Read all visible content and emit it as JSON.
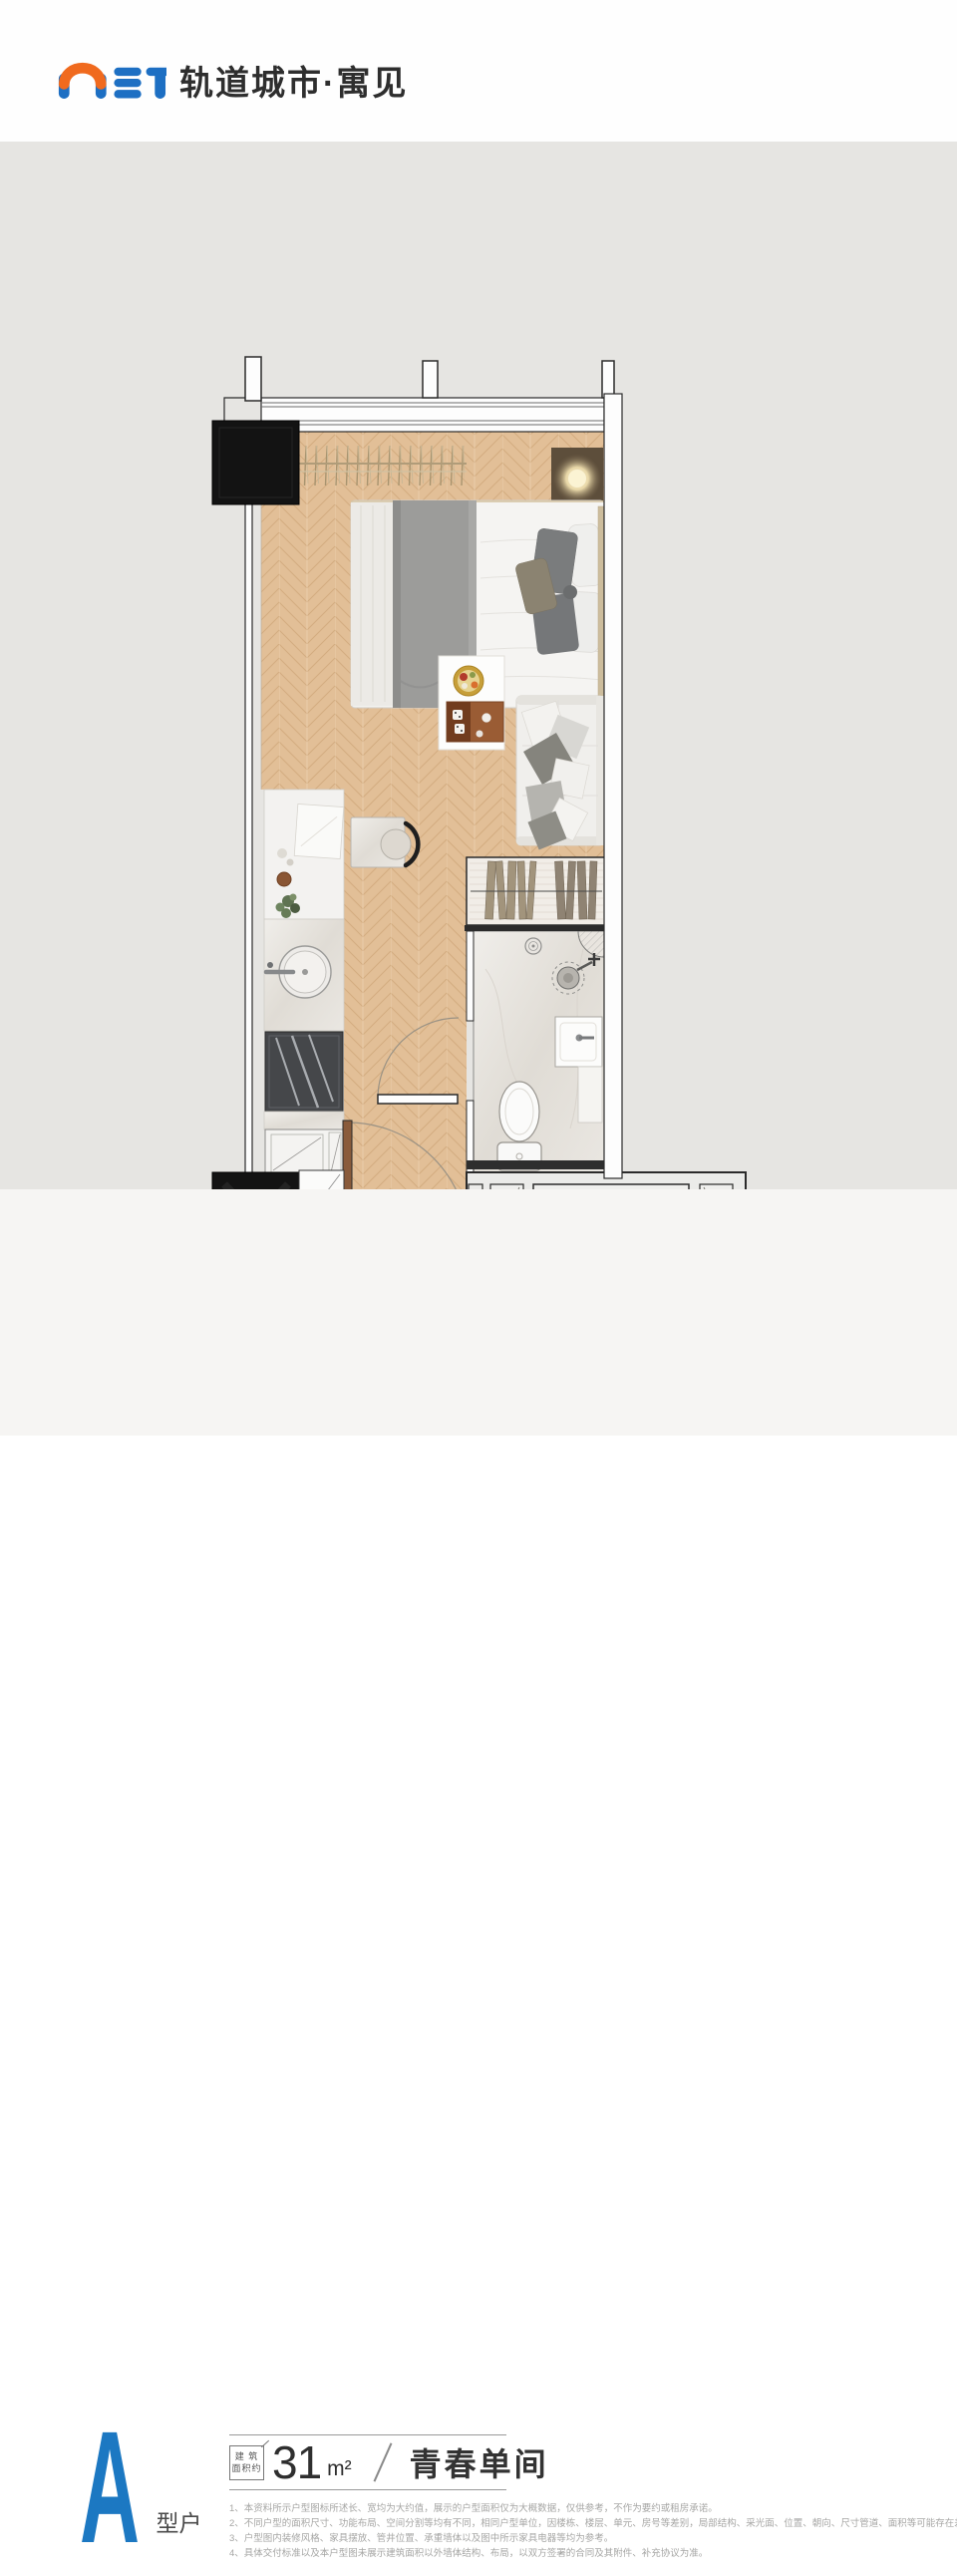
{
  "header": {
    "brand_text": "轨道城市·寓见",
    "logo_letters": "MET"
  },
  "unit": {
    "letter": "A",
    "type_label": "户型",
    "area_tag_line1": "建 筑",
    "area_tag_line2": "面积约",
    "area_value": "31",
    "area_unit": "m²",
    "name": "青春单间"
  },
  "disclaimers": [
    "1、本资料所示户型图标所述长、宽均为大约值，展示的户型面积仅为大概数据，仅供参考，不作为要约或租房承诺。",
    "2、不同户型的面积尺寸、功能布局、空间分割等均有不同，相同户型单位，因楼栋、楼层、单元、房号等差别，局部结构、采光面、位置、朝向、尺寸管道、面积等可能存在差异。",
    "3、户型图内装修风格、家具摆放、管井位置、承重墙体以及图中所示家具电器等均为参考。",
    "4、具体交付标准以及本户型图未展示建筑面积以外墙体结构、布局，以双方签署的合同及其附件、补充协议为准。"
  ],
  "colors": {
    "brand_blue": "#1c78c2",
    "brand_orange": "#f06a1e",
    "board_gray": "#e6e5e2",
    "wood_floor": "#e2bf97"
  },
  "floorplan": {
    "elements": [
      "window-band",
      "structural-shaft-top",
      "structural-shaft-bottom",
      "wardrobe-hanger-rack",
      "bedside-lamp",
      "double-bed",
      "pillows",
      "side-table",
      "food-tray",
      "sofa",
      "kitchen-counter",
      "cutting-board",
      "plant",
      "kitchen-sink",
      "cooktop",
      "kitchen-cabinet",
      "dining-table",
      "dining-chair",
      "laundry-closet",
      "bathroom-floor",
      "floor-drain",
      "corner-shelf",
      "shower",
      "vanity-sink",
      "toilet",
      "bathroom-door",
      "entry-door",
      "ac-platform"
    ]
  }
}
